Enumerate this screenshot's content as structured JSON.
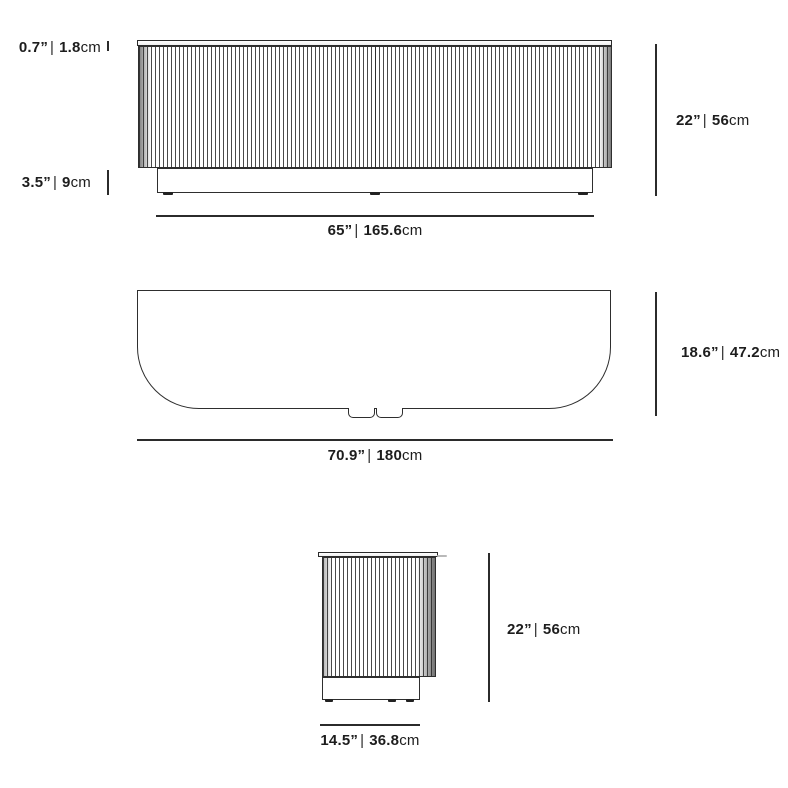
{
  "page": {
    "background": "#ffffff",
    "line_color": "#2b2b2b",
    "text_color": "#1d1d1d"
  },
  "views": {
    "front": {
      "dims": {
        "top_thickness": {
          "imperial": "0.7”",
          "sep": "|",
          "metric": "1.8",
          "unit": "cm"
        },
        "base_height": {
          "imperial": "3.5”",
          "sep": "|",
          "metric": "9",
          "unit": "cm"
        },
        "height": {
          "imperial": "22”",
          "sep": "|",
          "metric": "56",
          "unit": "cm"
        },
        "width": {
          "imperial": "65”",
          "sep": "|",
          "metric": "165.6",
          "unit": "cm"
        }
      }
    },
    "top": {
      "dims": {
        "depth": {
          "imperial": "18.6”",
          "sep": "|",
          "metric": "47.2",
          "unit": "cm"
        },
        "width": {
          "imperial": "70.9”",
          "sep": "|",
          "metric": "180",
          "unit": "cm"
        }
      }
    },
    "side": {
      "dims": {
        "height": {
          "imperial": "22”",
          "sep": "|",
          "metric": "56",
          "unit": "cm"
        },
        "width": {
          "imperial": "14.5”",
          "sep": "|",
          "metric": "36.8",
          "unit": "cm"
        }
      }
    }
  }
}
